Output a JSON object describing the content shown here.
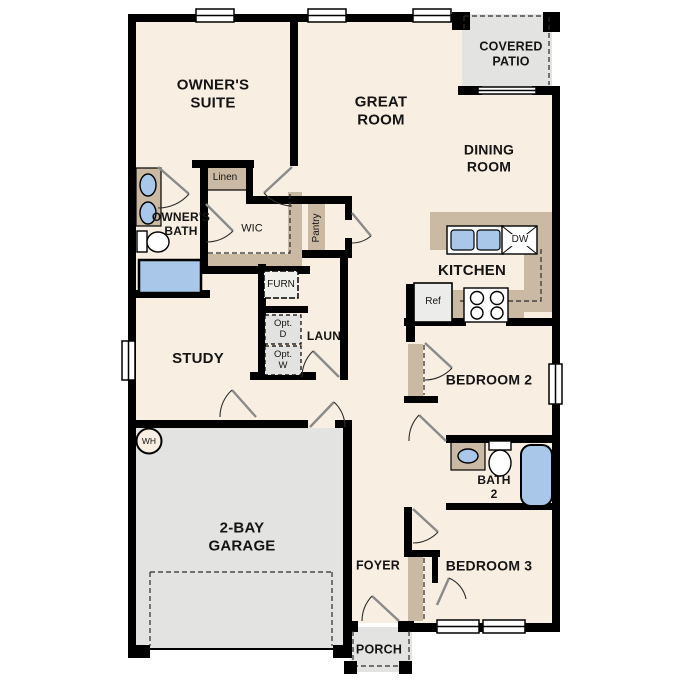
{
  "plan_title": "single-story floor plan",
  "colors": {
    "wall": "#000000",
    "floor": "#f8eee1",
    "concrete": "#e3e3e1",
    "cabinet_tan": "#cbbaa3",
    "fixture_blue": "#a9c7e8",
    "appliance_gray": "#ececea"
  },
  "rooms": {
    "owners_suite": {
      "label": "OWNER'S\nSUITE"
    },
    "great_room": {
      "label": "GREAT\nROOM"
    },
    "covered_patio": {
      "label": "COVERED\nPATIO"
    },
    "dining_room": {
      "label": "DINING\nROOM"
    },
    "kitchen": {
      "label": "KITCHEN"
    },
    "owners_bath": {
      "label": "OWNER'S\nBATH"
    },
    "wic": {
      "label": "WIC"
    },
    "study": {
      "label": "STUDY"
    },
    "laundry": {
      "label": "LAUN"
    },
    "garage": {
      "label": "2-BAY\nGARAGE"
    },
    "foyer": {
      "label": "FOYER"
    },
    "porch": {
      "label": "PORCH"
    },
    "bedroom2": {
      "label": "BEDROOM 2"
    },
    "bath2": {
      "label": "BATH\n2"
    },
    "bedroom3": {
      "label": "BEDROOM 3"
    }
  },
  "fixtures": {
    "linen": "Linen",
    "pantry": "Pantry",
    "furnace": "FURN",
    "opt_dryer": "Opt.\nD",
    "opt_washer": "Opt.\nW",
    "water_heater": "WH",
    "refrigerator": "Ref",
    "dishwasher": "DW"
  }
}
